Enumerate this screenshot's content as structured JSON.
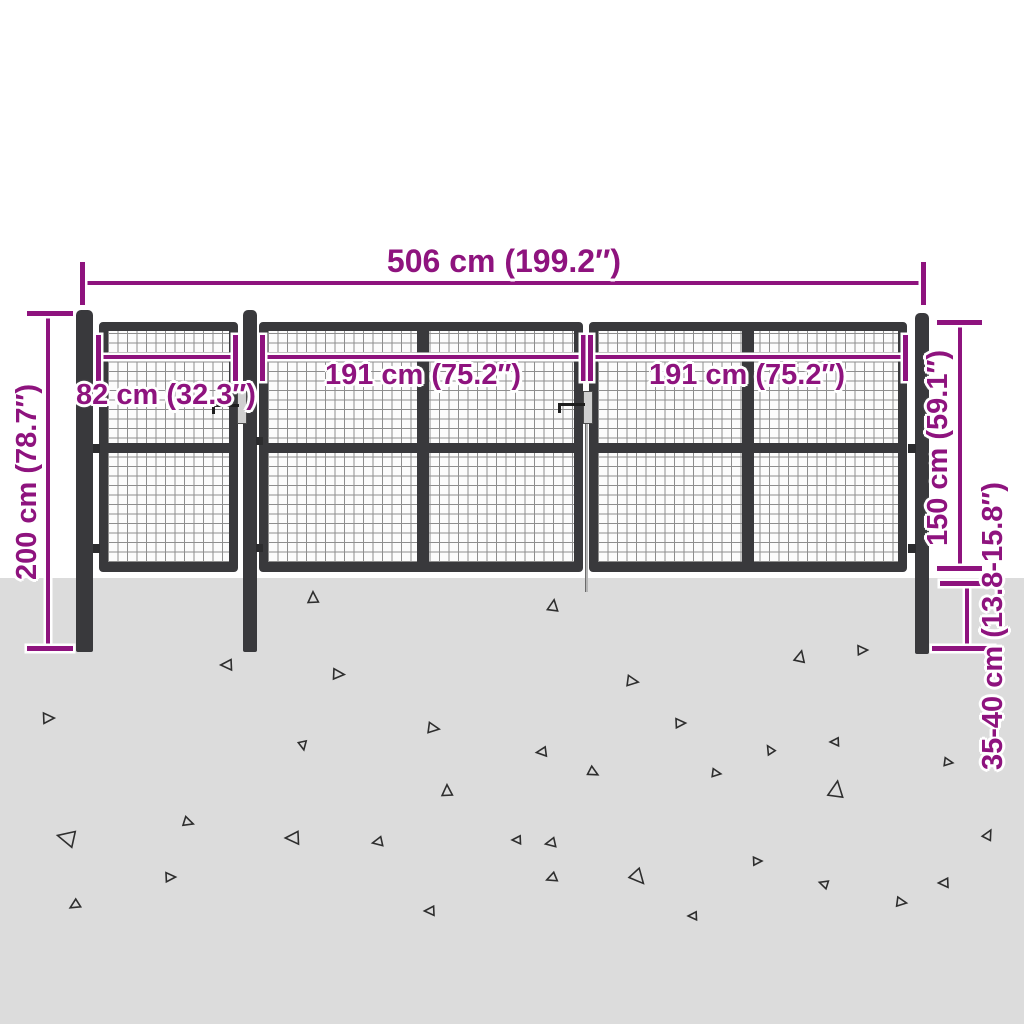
{
  "diagram": {
    "subject": "mesh-garden-gate-dimension-diagram",
    "colors": {
      "dimension_accent": "#8E137E",
      "steel_frame": "#39393C",
      "mesh_line": "#8E8E8E",
      "mesh_background": "#FCFCFC",
      "ground": "#DCDCDC",
      "background": "#FFFFFF",
      "latch_plate": "#CFCFCF"
    },
    "dimensions": {
      "total_width": {
        "label": "506 cm (199.2″)",
        "value_cm": "506",
        "value_in": "199.2"
      },
      "small_gate_width": {
        "label": "82 cm (32.3″)",
        "value_cm": "82",
        "value_in": "32.3"
      },
      "left_leaf_width": {
        "label": "191 cm (75.2″)",
        "value_cm": "191",
        "value_in": "75.2"
      },
      "right_leaf_width": {
        "label": "191 cm (75.2″)",
        "value_cm": "191",
        "value_in": "75.2"
      },
      "post_height": {
        "label": "200 cm (78.7″)",
        "value_cm": "200",
        "value_in": "78.7"
      },
      "above_ground_height": {
        "label": "150 cm (59.1″)",
        "value_cm": "150",
        "value_in": "59.1"
      },
      "ground_anchor_depth": {
        "label": "35-40 cm (13.8-15.8″)",
        "value_cm": "35-40",
        "value_in": "13.8-15.8"
      }
    },
    "ground": {
      "triangles": [
        {
          "x": 313,
          "y": 598,
          "s": 0.9,
          "r": 0
        },
        {
          "x": 553,
          "y": 606,
          "s": 0.9,
          "r": 10
        },
        {
          "x": 227,
          "y": 665,
          "s": 0.9,
          "r": -90
        },
        {
          "x": 338,
          "y": 674,
          "s": 0.9,
          "r": 95
        },
        {
          "x": 632,
          "y": 681,
          "s": 0.9,
          "r": 100
        },
        {
          "x": 800,
          "y": 657,
          "s": 0.9,
          "r": 15
        },
        {
          "x": 862,
          "y": 650,
          "s": 0.8,
          "r": 90
        },
        {
          "x": 48,
          "y": 718,
          "s": 0.9,
          "r": 90
        },
        {
          "x": 188,
          "y": 822,
          "s": 0.8,
          "r": 110
        },
        {
          "x": 303,
          "y": 745,
          "s": 0.7,
          "r": 170
        },
        {
          "x": 447,
          "y": 791,
          "s": 0.9,
          "r": 0
        },
        {
          "x": 433,
          "y": 728,
          "s": 0.9,
          "r": 100
        },
        {
          "x": 542,
          "y": 752,
          "s": 0.8,
          "r": -95
        },
        {
          "x": 67,
          "y": 838,
          "s": 1.4,
          "r": -75
        },
        {
          "x": 293,
          "y": 838,
          "s": 1.1,
          "r": -90
        },
        {
          "x": 378,
          "y": 842,
          "s": 0.8,
          "r": -100
        },
        {
          "x": 170,
          "y": 877,
          "s": 0.8,
          "r": 90
        },
        {
          "x": 75,
          "y": 905,
          "s": 0.8,
          "r": -120
        },
        {
          "x": 430,
          "y": 911,
          "s": 0.8,
          "r": -90
        },
        {
          "x": 593,
          "y": 772,
          "s": 0.8,
          "r": 120
        },
        {
          "x": 716,
          "y": 773,
          "s": 0.7,
          "r": 100
        },
        {
          "x": 770,
          "y": 750,
          "s": 0.7,
          "r": -30
        },
        {
          "x": 835,
          "y": 742,
          "s": 0.7,
          "r": -90
        },
        {
          "x": 948,
          "y": 762,
          "s": 0.7,
          "r": 100
        },
        {
          "x": 836,
          "y": 790,
          "s": 1.3,
          "r": 10
        },
        {
          "x": 988,
          "y": 835,
          "s": 0.8,
          "r": 30
        },
        {
          "x": 551,
          "y": 843,
          "s": 0.8,
          "r": -100
        },
        {
          "x": 638,
          "y": 877,
          "s": 1.2,
          "r": 140
        },
        {
          "x": 757,
          "y": 861,
          "s": 0.7,
          "r": 90
        },
        {
          "x": 944,
          "y": 883,
          "s": 0.8,
          "r": -90
        },
        {
          "x": 824,
          "y": 884,
          "s": 0.7,
          "r": -70
        },
        {
          "x": 693,
          "y": 916,
          "s": 0.7,
          "r": -90
        },
        {
          "x": 901,
          "y": 902,
          "s": 0.8,
          "r": 100
        },
        {
          "x": 680,
          "y": 723,
          "s": 0.8,
          "r": 90
        },
        {
          "x": 517,
          "y": 840,
          "s": 0.7,
          "r": -90
        },
        {
          "x": 552,
          "y": 878,
          "s": 0.8,
          "r": -110
        }
      ]
    }
  }
}
